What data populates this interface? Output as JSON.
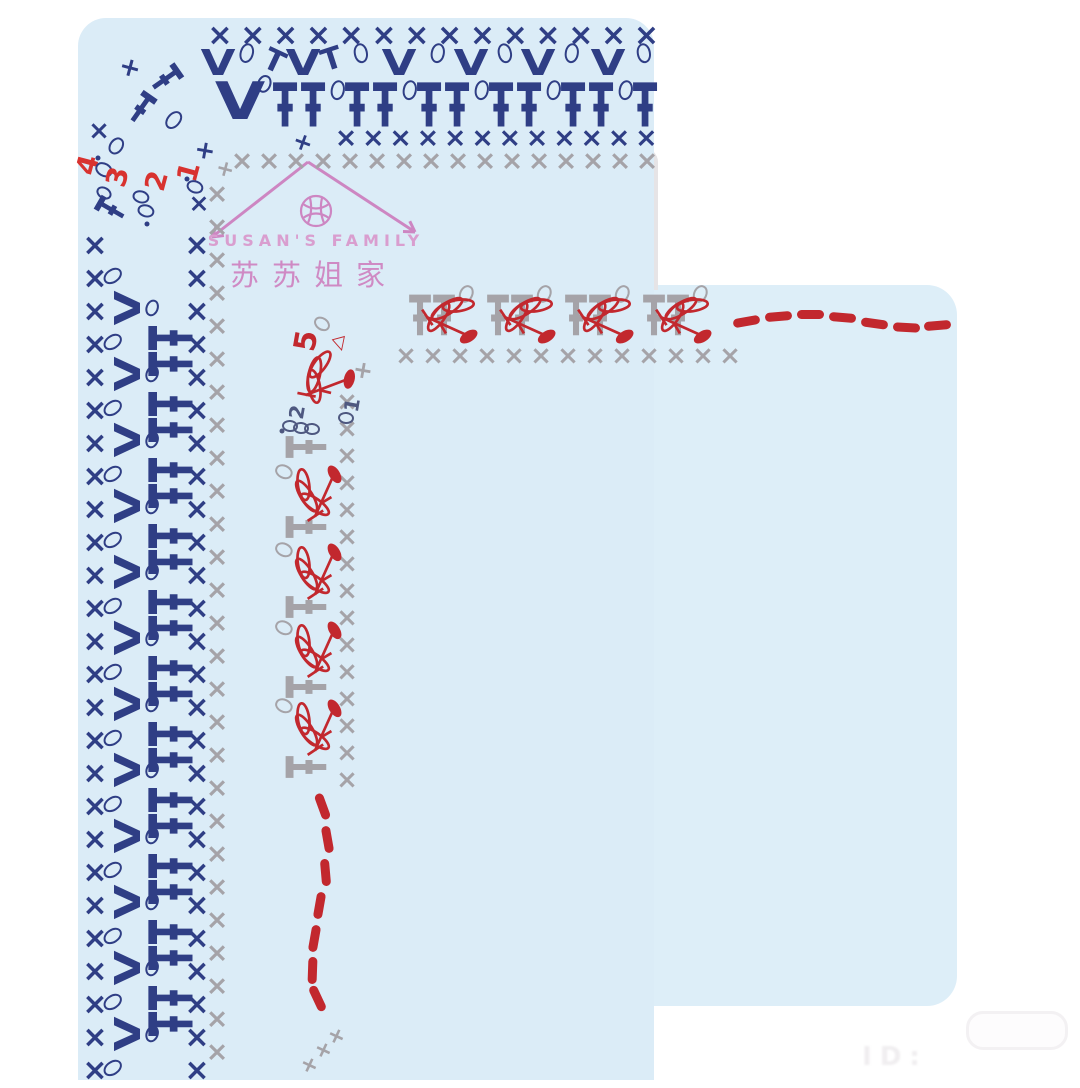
{
  "watermark": {
    "brand_en": "SUSAN'S FAMILY",
    "brand_cn": "苏苏姐家",
    "arrow": {
      "peak_x": 308,
      "peak_y": 162,
      "left_x": 212,
      "left_y": 237,
      "right_x": 415,
      "right_y": 232
    },
    "yarn_icon_x": 316,
    "yarn_icon_y": 211
  },
  "footer": {
    "id_text": "ID:"
  },
  "colors": {
    "navy": "#2f3e85",
    "gray": "#a5a3a8",
    "red": "#c2282e",
    "red2": "#d8322f",
    "dark": "#4e5880",
    "pink": "#cd86c2",
    "panel_blue": "#dbecf7",
    "panel_blue2": "#ddeef8",
    "panel_gray": "#e6e4e6",
    "panel_gray2": "#e9e8ea"
  },
  "row_numbers": {
    "outer": [
      "1",
      "2",
      "3",
      "4"
    ],
    "inner": [
      "1",
      "2",
      "5"
    ]
  },
  "diagram": {
    "panels": [
      {
        "name": "outer-swatch-blue-panel",
        "x": 78,
        "y": 18,
        "w": 576,
        "h": 1062,
        "rad": "28px 28px 0 0",
        "c": "panel_blue"
      },
      {
        "name": "outer-fabric-gray-band",
        "x": 198,
        "y": 148,
        "w": 460,
        "h": 142,
        "rad": "6px 14px 0 0",
        "c": "panel_gray"
      },
      {
        "name": "outer-fabric-gray-strip",
        "x": 198,
        "y": 148,
        "w": 68,
        "h": 932,
        "rad": "0",
        "c": "panel_gray"
      },
      {
        "name": "inner-swatch-blue-panel",
        "x": 268,
        "y": 285,
        "w": 689,
        "h": 721,
        "rad": "30px 30px 30px 30px",
        "c": "panel_blue2"
      },
      {
        "name": "inner-fabric-gray-panel",
        "x": 374,
        "y": 368,
        "w": 578,
        "h": 632,
        "rad": "28px 22px 22px 24px",
        "c": "panel_gray2"
      }
    ],
    "runs": [
      {
        "g": "x",
        "c": "navy",
        "s": 30,
        "x": 220,
        "y": 36,
        "dx": 32.8,
        "n": 14
      },
      {
        "g": "dc",
        "c": "navy",
        "s": 42,
        "x": 285,
        "y": 106,
        "dx": 72,
        "n": 6
      },
      {
        "g": "dc",
        "c": "navy",
        "s": 42,
        "x": 313,
        "y": 106,
        "dx": 72,
        "n": 5
      },
      {
        "g": "ch",
        "c": "navy",
        "s": 13,
        "x": 338,
        "y": 90,
        "dx": 72,
        "n": 5,
        "r": 10
      },
      {
        "g": "x",
        "c": "navy",
        "s": 27,
        "x": 346,
        "y": 138,
        "dx": 27.3,
        "n": 12
      },
      {
        "g": "x",
        "c": "gray",
        "s": 27,
        "x": 242,
        "y": 161,
        "dx": 27,
        "n": 16
      },
      {
        "g": "x",
        "c": "navy",
        "s": 30,
        "x": 95,
        "y": 246,
        "dy": 33,
        "n": 26
      },
      {
        "g": "ch",
        "c": "navy",
        "s": 13,
        "x": 113,
        "y": 276,
        "dy": 66,
        "n": 13,
        "r": 55
      },
      {
        "g": "v",
        "c": "navy",
        "s": 36,
        "x": 129,
        "y": 308,
        "dy": 66,
        "n": 12,
        "r": -90
      },
      {
        "g": "ch",
        "c": "navy",
        "s": 11,
        "x": 152,
        "y": 308,
        "dy": 66,
        "n": 12,
        "r": 20
      },
      {
        "g": "dc",
        "c": "navy",
        "s": 42,
        "x": 172,
        "y": 338,
        "dy": 66,
        "n": 11,
        "r": -90
      },
      {
        "g": "dc",
        "c": "navy",
        "s": 42,
        "x": 172,
        "y": 364,
        "dy": 66,
        "n": 11,
        "r": -90
      },
      {
        "g": "x",
        "c": "navy",
        "s": 30,
        "x": 197,
        "y": 246,
        "dy": 33,
        "n": 26
      },
      {
        "g": "x",
        "c": "gray",
        "s": 27,
        "x": 217,
        "y": 194,
        "dy": 33,
        "n": 27
      },
      {
        "g": "dc",
        "c": "gray",
        "s": 38,
        "x": 420,
        "y": 316,
        "dx": 78,
        "n": 4
      },
      {
        "g": "dc",
        "c": "gray",
        "s": 38,
        "x": 444,
        "y": 316,
        "dx": 78,
        "n": 4
      },
      {
        "g": "ch",
        "c": "gray",
        "s": 12,
        "x": 466,
        "y": 294,
        "dx": 78,
        "n": 4,
        "r": 25
      },
      {
        "g": "x",
        "c": "gray",
        "s": 26,
        "x": 406,
        "y": 356,
        "dx": 27,
        "n": 13
      },
      {
        "g": "x",
        "c": "gray",
        "s": 26,
        "x": 347,
        "y": 402,
        "dy": 27,
        "n": 15
      },
      {
        "g": "dc",
        "c": "gray",
        "s": 38,
        "x": 307,
        "y": 447,
        "dy": 80,
        "n": 5,
        "r": -90
      },
      {
        "g": "ch",
        "c": "gray",
        "s": 12,
        "x": 284,
        "y": 472,
        "dy": 78,
        "n": 4,
        "r": -65
      }
    ],
    "marks": [
      {
        "g": "v",
        "c": "navy",
        "s": 36,
        "x": 218,
        "y": 64
      },
      {
        "g": "ch",
        "c": "navy",
        "s": 13,
        "x": 247,
        "y": 53,
        "r": 15
      },
      {
        "g": "t",
        "c": "navy",
        "s": 30,
        "x": 274,
        "y": 62,
        "r": 25
      },
      {
        "g": "v",
        "c": "navy",
        "s": 36,
        "x": 303,
        "y": 64
      },
      {
        "g": "t",
        "c": "navy",
        "s": 30,
        "x": 332,
        "y": 60,
        "r": -18
      },
      {
        "g": "ch",
        "c": "navy",
        "s": 13,
        "x": 361,
        "y": 53,
        "r": -10
      },
      {
        "g": "v",
        "c": "navy",
        "s": 36,
        "x": 399,
        "y": 64
      },
      {
        "g": "ch",
        "c": "navy",
        "s": 13,
        "x": 438,
        "y": 53,
        "r": 10
      },
      {
        "g": "v",
        "c": "navy",
        "s": 36,
        "x": 471,
        "y": 64
      },
      {
        "g": "ch",
        "c": "navy",
        "s": 13,
        "x": 505,
        "y": 53,
        "r": -12
      },
      {
        "g": "v",
        "c": "navy",
        "s": 36,
        "x": 538,
        "y": 64
      },
      {
        "g": "ch",
        "c": "navy",
        "s": 13,
        "x": 572,
        "y": 53,
        "r": 8
      },
      {
        "g": "v",
        "c": "navy",
        "s": 36,
        "x": 608,
        "y": 64
      },
      {
        "g": "ch",
        "c": "navy",
        "s": 13,
        "x": 644,
        "y": 53,
        "r": -10
      },
      {
        "g": "v",
        "c": "navy",
        "s": 52,
        "x": 240,
        "y": 102
      },
      {
        "g": "ch",
        "c": "navy",
        "s": 12,
        "x": 264,
        "y": 84,
        "r": 20
      },
      {
        "g": "plus",
        "c": "navy",
        "s": 26,
        "x": 130,
        "y": 68,
        "r": 15
      },
      {
        "g": "dc",
        "c": "navy",
        "s": 30,
        "x": 164,
        "y": 80,
        "r": 55
      },
      {
        "g": "dc",
        "c": "navy",
        "s": 30,
        "x": 140,
        "y": 110,
        "r": 35
      },
      {
        "g": "ch",
        "c": "navy",
        "s": 13,
        "x": 174,
        "y": 120,
        "r": 40
      },
      {
        "g": "x",
        "c": "navy",
        "s": 26,
        "x": 99,
        "y": 131
      },
      {
        "g": "ch",
        "c": "navy",
        "s": 12,
        "x": 116,
        "y": 146,
        "r": 35
      },
      {
        "g": "plus",
        "c": "navy",
        "s": 25,
        "x": 205,
        "y": 150,
        "r": 10
      },
      {
        "g": "plus",
        "c": "gray",
        "s": 22,
        "x": 225,
        "y": 170,
        "r": 15
      },
      {
        "g": "plus",
        "c": "navy",
        "s": 24,
        "x": 303,
        "y": 142,
        "r": 20
      },
      {
        "t": "4",
        "c": "red2",
        "s": 28,
        "x": 88,
        "y": 165,
        "r": -75
      },
      {
        "g": "ch",
        "c": "navy",
        "s": 12,
        "x": 104,
        "y": 170,
        "r": -60
      },
      {
        "g": "dot",
        "c": "navy",
        "s": 5,
        "x": 98,
        "y": 158
      },
      {
        "t": "3",
        "c": "red2",
        "s": 28,
        "x": 118,
        "y": 177,
        "r": -75
      },
      {
        "g": "ch",
        "c": "navy",
        "s": 10,
        "x": 104,
        "y": 193,
        "r": -60
      },
      {
        "g": "dc",
        "c": "navy",
        "s": 28,
        "x": 112,
        "y": 210,
        "r": -60
      },
      {
        "t": "2",
        "c": "red2",
        "s": 28,
        "x": 157,
        "y": 181,
        "r": -75
      },
      {
        "g": "ch",
        "c": "navy",
        "s": 11,
        "x": 141,
        "y": 197,
        "r": -75
      },
      {
        "g": "ch",
        "c": "navy",
        "s": 11,
        "x": 146,
        "y": 211,
        "r": -75
      },
      {
        "g": "dot",
        "c": "navy",
        "s": 5,
        "x": 147,
        "y": 224
      },
      {
        "t": "1",
        "c": "red2",
        "s": 28,
        "x": 189,
        "y": 172,
        "r": -75
      },
      {
        "g": "ch",
        "c": "navy",
        "s": 11,
        "x": 195,
        "y": 187,
        "r": -70
      },
      {
        "g": "dot",
        "c": "navy",
        "s": 5,
        "x": 187,
        "y": 179
      },
      {
        "g": "x",
        "c": "navy",
        "s": 25,
        "x": 199,
        "y": 203
      },
      {
        "t": "5",
        "c": "red",
        "s": 30,
        "x": 307,
        "y": 341,
        "r": -80
      },
      {
        "g": "ch",
        "c": "gray",
        "s": 11,
        "x": 322,
        "y": 324,
        "r": -55
      },
      {
        "g": "tri",
        "c": "red",
        "s": 18,
        "x": 340,
        "y": 344,
        "r": -15
      },
      {
        "g": "plus",
        "c": "gray",
        "s": 24,
        "x": 363,
        "y": 370,
        "r": 10
      },
      {
        "t": "2",
        "c": "dark",
        "s": 20,
        "x": 297,
        "y": 412,
        "r": -80
      },
      {
        "g": "ch",
        "c": "dark",
        "s": 10,
        "x": 290,
        "y": 426,
        "r": -85
      },
      {
        "g": "ch",
        "c": "dark",
        "s": 10,
        "x": 301,
        "y": 428,
        "r": -85
      },
      {
        "g": "ch",
        "c": "dark",
        "s": 10,
        "x": 312,
        "y": 429,
        "r": -85
      },
      {
        "g": "dot",
        "c": "dark",
        "s": 5,
        "x": 282,
        "y": 431
      },
      {
        "t": "1",
        "c": "dark",
        "s": 20,
        "x": 352,
        "y": 405,
        "r": -80
      },
      {
        "g": "ch",
        "c": "dark",
        "s": 10,
        "x": 346,
        "y": 418,
        "r": -85
      },
      {
        "g": "plus",
        "c": "gray",
        "s": 22,
        "x": 309,
        "y": 1066,
        "r": 25
      },
      {
        "g": "plus",
        "c": "gray",
        "s": 22,
        "x": 323,
        "y": 1051,
        "r": 25
      },
      {
        "g": "plus",
        "c": "gray",
        "s": 22,
        "x": 336,
        "y": 1037,
        "r": 25
      }
    ],
    "clusters": [
      {
        "x": 448,
        "y": 320,
        "r": 0
      },
      {
        "x": 526,
        "y": 320,
        "r": 0
      },
      {
        "x": 604,
        "y": 320,
        "r": 0
      },
      {
        "x": 682,
        "y": 320,
        "r": 0
      },
      {
        "x": 323,
        "y": 382,
        "r": -45
      },
      {
        "x": 318,
        "y": 495,
        "r": -90
      },
      {
        "x": 318,
        "y": 573,
        "r": -90
      },
      {
        "x": 318,
        "y": 651,
        "r": -90
      },
      {
        "x": 318,
        "y": 729,
        "r": -90
      }
    ],
    "dashes": [
      {
        "x": 746,
        "y": 321,
        "r": -10,
        "len": 27
      },
      {
        "x": 778,
        "y": 316,
        "r": -5,
        "len": 27
      },
      {
        "x": 810,
        "y": 314,
        "r": 0,
        "len": 27
      },
      {
        "x": 842,
        "y": 317,
        "r": 5,
        "len": 27
      },
      {
        "x": 874,
        "y": 323,
        "r": 8,
        "len": 27
      },
      {
        "x": 906,
        "y": 327,
        "r": 3,
        "len": 27
      },
      {
        "x": 937,
        "y": 325,
        "r": -5,
        "len": 27
      },
      {
        "x": 322,
        "y": 806,
        "r": 70,
        "len": 27
      },
      {
        "x": 327,
        "y": 839,
        "r": 80,
        "len": 27
      },
      {
        "x": 325,
        "y": 872,
        "r": 85,
        "len": 27
      },
      {
        "x": 319,
        "y": 905,
        "r": 100,
        "len": 27
      },
      {
        "x": 314,
        "y": 938,
        "r": 100,
        "len": 27
      },
      {
        "x": 312,
        "y": 970,
        "r": 92,
        "len": 27
      },
      {
        "x": 317,
        "y": 998,
        "r": 65,
        "len": 27
      }
    ]
  }
}
